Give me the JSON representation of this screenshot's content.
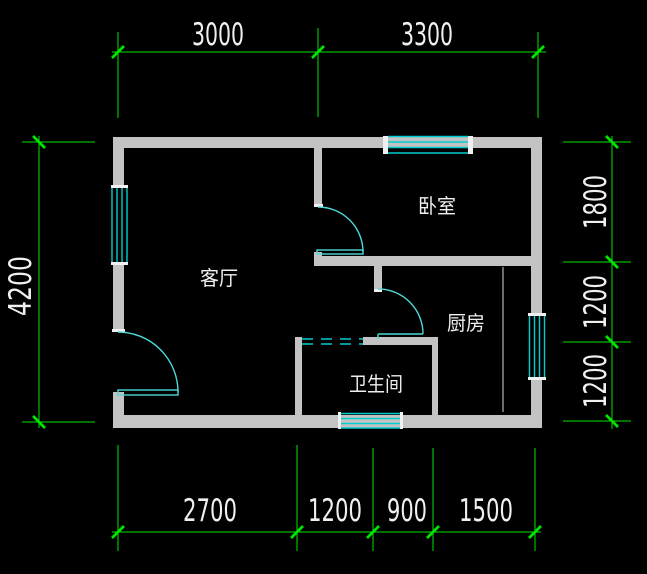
{
  "drawing": {
    "kind": "architectural floor plan (CAD)",
    "units": "mm"
  },
  "colors": {
    "bg": "#000000",
    "wall": "#c3c3c3",
    "cap": "#f0f0f0",
    "window": "#00cdcd",
    "door": "#4fd8d8",
    "dim": "#00e400",
    "text": "#f0f0f0"
  },
  "rooms": [
    {
      "id": "living-room",
      "label": "客厅"
    },
    {
      "id": "bedroom",
      "label": "卧室"
    },
    {
      "id": "kitchen",
      "label": "厨房"
    },
    {
      "id": "bathroom",
      "label": "卫生间"
    }
  ],
  "dimensions": {
    "top": [
      "3000",
      "3300"
    ],
    "left": [
      "4200"
    ],
    "right": [
      "1800",
      "1200",
      "1200"
    ],
    "bottom": [
      "2700",
      "1200",
      "900",
      "1500"
    ]
  }
}
